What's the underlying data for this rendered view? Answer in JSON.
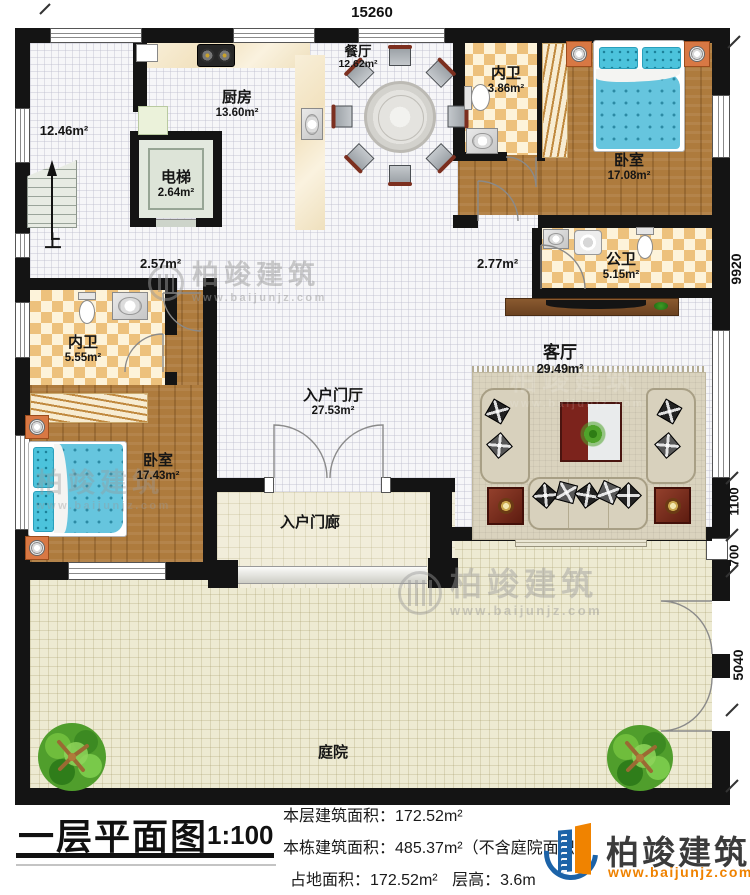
{
  "titleblock": {
    "title": "一层平面图",
    "scale": "1:100"
  },
  "stats": [
    {
      "label": "本层建筑面积：",
      "value": "172.52m²"
    },
    {
      "label": "本栋建筑面积：",
      "value": "485.37m²（不含庭院面积）"
    },
    {
      "label": "占地面积：",
      "value": "172.52m²",
      "label2": "层高：",
      "value2": "3.6m"
    }
  ],
  "brand": {
    "name": "柏竣建筑",
    "url": "www.baijunjz.com"
  },
  "watermark": {
    "name": "柏竣建筑",
    "url": "www.baijunjz.com"
  },
  "dims": {
    "top": "15260",
    "right": [
      "9920",
      "1100",
      "700",
      "5040"
    ]
  },
  "rooms": {
    "stair_hall": {
      "area": "12.46m²",
      "up": "上"
    },
    "elevator": {
      "name": "电梯",
      "area": "2.64m²"
    },
    "kitchen": {
      "name": "厨房",
      "area": "13.60m²"
    },
    "dining": {
      "name": "餐厅",
      "area": "12.62m²"
    },
    "bath_top": {
      "name": "内卫",
      "area": "3.86m²"
    },
    "bedroom_right": {
      "name": "卧室",
      "area": "17.08m²"
    },
    "public_bath": {
      "name": "公卫",
      "area": "5.15m²"
    },
    "hall_a": {
      "area": "2.57m²"
    },
    "hall_b": {
      "area": "2.77m²"
    },
    "bath_left": {
      "name": "内卫",
      "area": "5.55m²"
    },
    "bedroom_left": {
      "name": "卧室",
      "area": "17.43m²"
    },
    "foyer": {
      "name": "入户门厅",
      "area": "27.53m²"
    },
    "living": {
      "name": "客厅",
      "area": "29.49m²"
    },
    "porch": {
      "name": "入户门廊"
    },
    "courtyard": {
      "name": "庭院"
    }
  },
  "colors": {
    "wall": "#141414",
    "checker": "#edc17c",
    "wood": "#ae7b3d",
    "bed": "#64c4de",
    "brand_orange": "#ef8200",
    "brand_blue": "#1c63a8"
  }
}
